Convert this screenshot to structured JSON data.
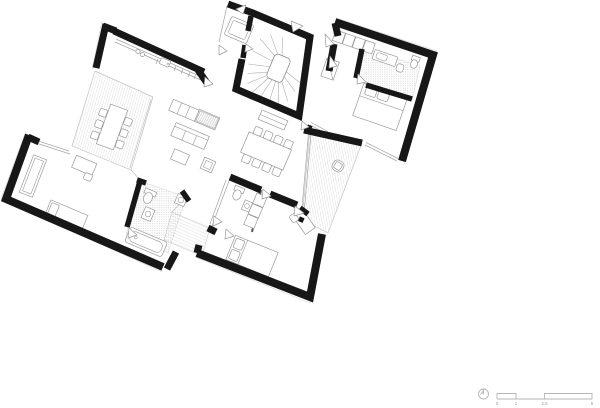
{
  "scale_bar": {
    "labels": [
      "0",
      "1",
      "2.5",
      "5"
    ]
  },
  "icons": [
    "north-arrow-icon"
  ],
  "colors": {
    "wall": "#171717",
    "furniture_line": "#9a9a9a",
    "hatch": "#cacaca",
    "stipple": "#c2c2c2",
    "scale_gray": "#b5b5b5",
    "background": "#ffffff"
  }
}
